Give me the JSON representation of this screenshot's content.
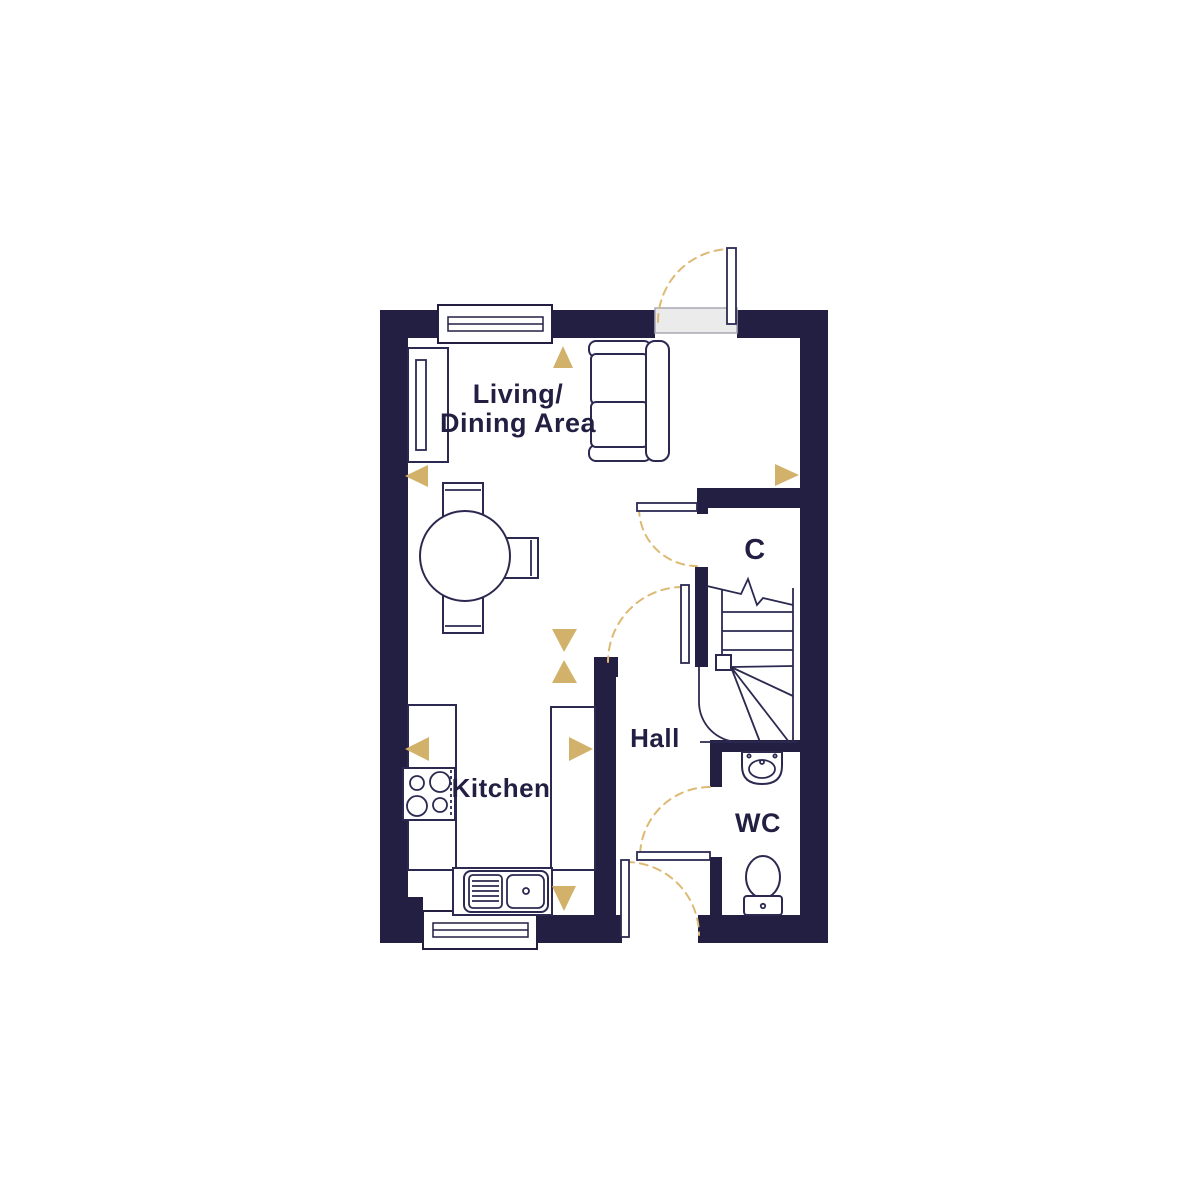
{
  "floorplan": {
    "background": "#ffffff",
    "colors": {
      "wall": "#221f42",
      "furniture_line": "#2b2950",
      "label_text": "#221f42",
      "accent_gold": "#d2b26b",
      "door_swing_gold": "#ddba74",
      "threshold_fill": "#ebebeb"
    },
    "rooms": {
      "living_dining": {
        "label_line1": "Living/",
        "label_line2": "Dining Area"
      },
      "kitchen": {
        "label": "Kitchen"
      },
      "hall": {
        "label": "Hall"
      },
      "wc": {
        "label": "WC"
      },
      "cupboard": {
        "label": "C"
      }
    },
    "symbols": [
      "window",
      "entrance-door-swing",
      "direction-arrow",
      "sofa",
      "sideboard",
      "dining-table",
      "dining-chair",
      "stairs",
      "kitchen-counter",
      "hob",
      "sink",
      "wash-basin",
      "toilet"
    ]
  }
}
